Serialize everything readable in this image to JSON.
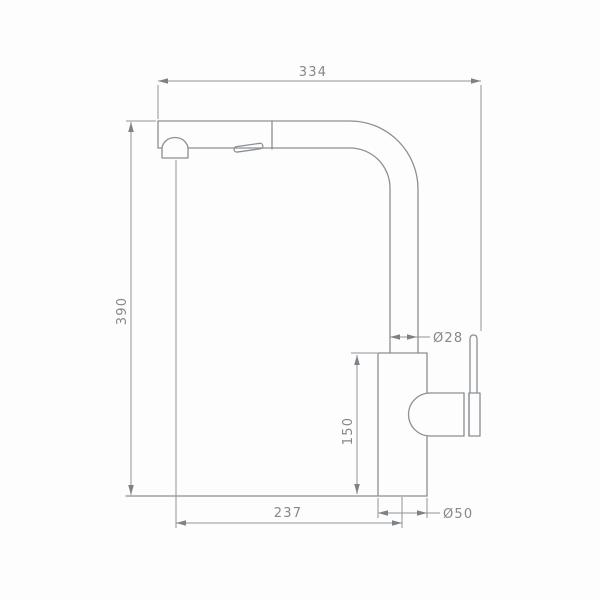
{
  "canvas": {
    "background": "#fdfdfd",
    "line_color": "#8b9095",
    "text_color": "#84888c"
  },
  "drawing": {
    "dimensions": {
      "overall_width": {
        "label": "334",
        "value": 334
      },
      "overall_height": {
        "label": "390",
        "value": 390
      },
      "pipe_diameter": {
        "label": "Ø28",
        "value": 28
      },
      "body_height": {
        "label": "150",
        "value": 150
      },
      "spout_reach": {
        "label": "237",
        "value": 237
      },
      "base_diameter": {
        "label": "Ø50",
        "value": 50
      }
    }
  }
}
